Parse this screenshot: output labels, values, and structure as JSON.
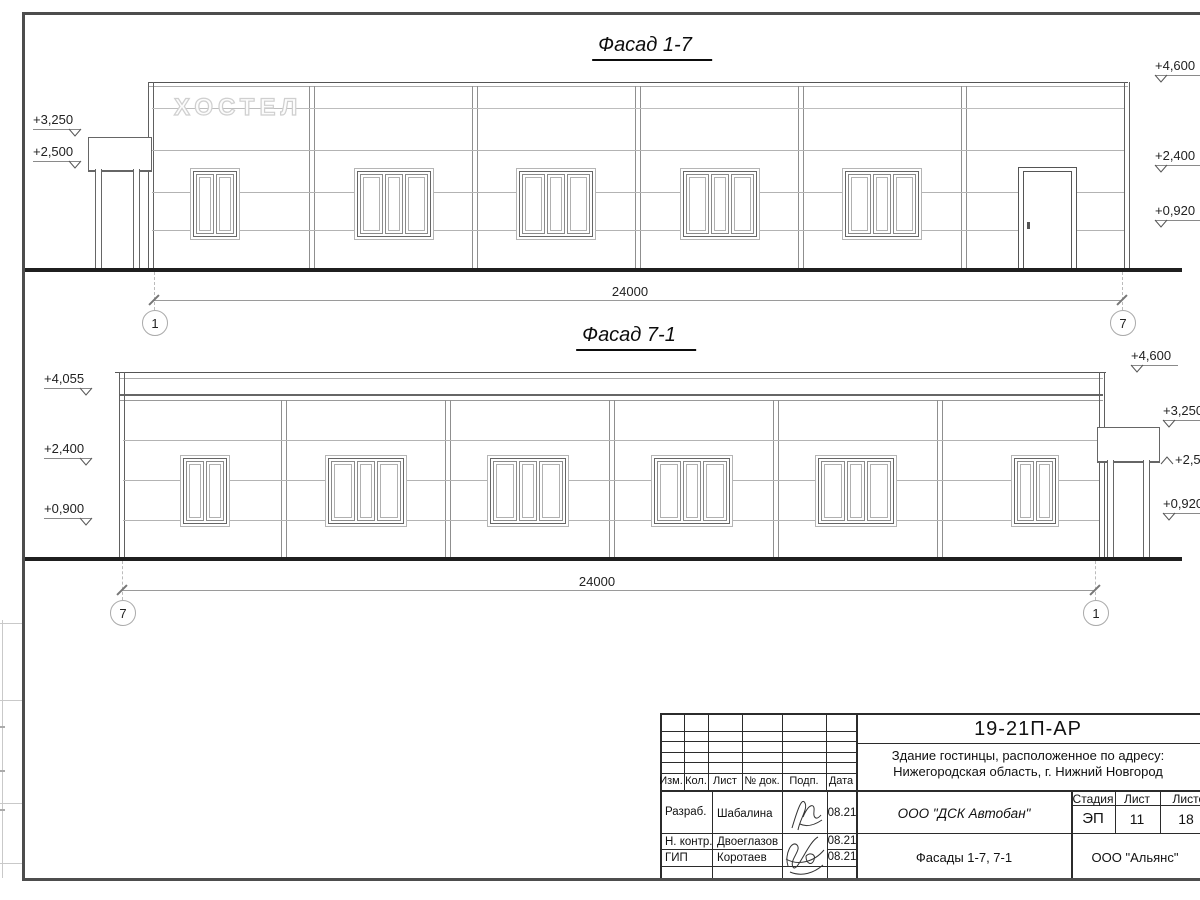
{
  "sheet": {
    "facade1": {
      "title": "Фасад 1-7",
      "sign": "ХОСТЕЛ",
      "marks_left": [
        "+3,250",
        "+2,500"
      ],
      "marks_right": [
        "+4,600",
        "+2,400",
        "+0,920"
      ],
      "dimension": "24000",
      "axis_left": "1",
      "axis_right": "7"
    },
    "facade2": {
      "title": "Фасад 7-1",
      "marks_left": [
        "+4,055",
        "+2,400",
        "+0,900"
      ],
      "marks_right": [
        "+4,600",
        "+3,250",
        "+2,500",
        "+0,920"
      ],
      "dimension": "24000",
      "axis_left": "7",
      "axis_right": "1"
    },
    "titleblock": {
      "doc_code": "19-21П-АР",
      "project_line1": "Здание гостинцы, расположенное по адресу:",
      "project_line2": "Нижегородская область, г. Нижний Новгород",
      "col_izm": "Изм.",
      "col_kol": "Кол.",
      "col_list": "Лист",
      "col_doc": "№ док.",
      "col_podp": "Подп.",
      "col_data": "Дата",
      "row1_role": "Разраб.",
      "row1_name": "Шабалина",
      "row1_date": "08.21",
      "row2_role": "Н. контр.",
      "row2_name": "Двоеглазов",
      "row2_date": "08.21",
      "row3_role": "ГИП",
      "row3_name": "Коротаев",
      "row3_date": "08.21",
      "company": "ООО \"ДСК Автобан\"",
      "stage_label": "Стадия",
      "stage": "ЭП",
      "sheet_label": "Лист",
      "sheet": "11",
      "sheets_label": "Листов",
      "sheets": "18",
      "subtitle": "Фасады 1-7, 7-1",
      "contractor": "ООО \"Альянс\""
    }
  }
}
